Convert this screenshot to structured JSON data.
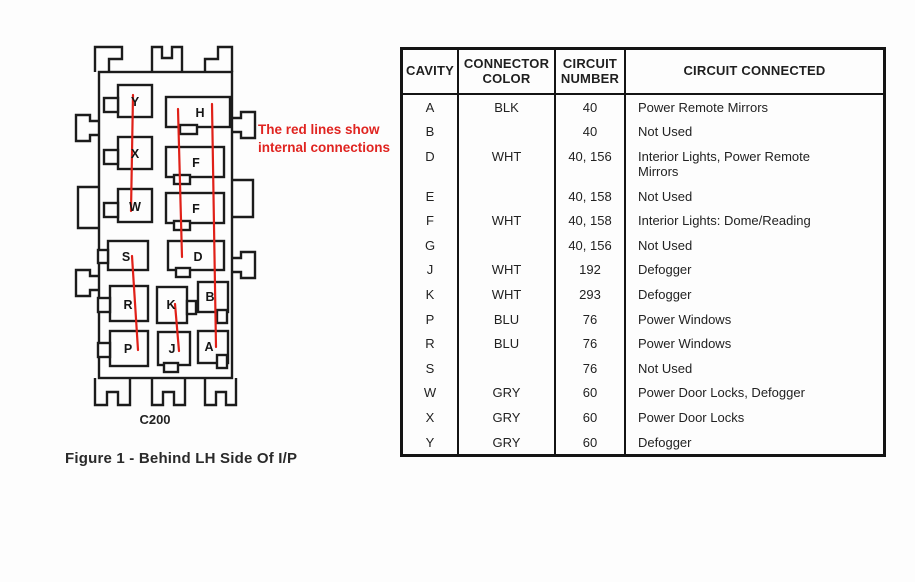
{
  "figure": {
    "connector_label": "C200",
    "caption": "Figure 1 - Behind LH Side Of I/P",
    "annotation": "The red lines show\ninternal connections",
    "cavities": [
      "Y",
      "H",
      "X",
      "F",
      "W",
      "F",
      "S",
      "D",
      "R",
      "K",
      "B",
      "P",
      "J",
      "A"
    ],
    "red_connections": [
      "Y-X-W",
      "H-F-F-D",
      "H-B-A",
      "S-P",
      "K-J"
    ]
  },
  "table": {
    "headers": {
      "cavity": "CAVITY",
      "color": "CONNECTOR\nCOLOR",
      "number": "CIRCUIT\nNUMBER",
      "connected": "CIRCUIT CONNECTED"
    },
    "rows": [
      {
        "cavity": "A",
        "color": "BLK",
        "number": "40",
        "connected": "Power Remote Mirrors"
      },
      {
        "cavity": "B",
        "color": "",
        "number": "40",
        "connected": "Not Used"
      },
      {
        "cavity": "D",
        "color": "WHT",
        "number": "40, 156",
        "connected": "Interior Lights, Power Remote\n Mirrors"
      },
      {
        "cavity": "E",
        "color": "",
        "number": "40, 158",
        "connected": "Not Used"
      },
      {
        "cavity": "F",
        "color": "WHT",
        "number": "40, 158",
        "connected": "Interior Lights: Dome/Reading"
      },
      {
        "cavity": "G",
        "color": "",
        "number": "40, 156",
        "connected": "Not Used"
      },
      {
        "cavity": "J",
        "color": "WHT",
        "number": "192",
        "connected": "Defogger"
      },
      {
        "cavity": "K",
        "color": "WHT",
        "number": "293",
        "connected": "Defogger"
      },
      {
        "cavity": "P",
        "color": "BLU",
        "number": "76",
        "connected": "Power Windows"
      },
      {
        "cavity": "R",
        "color": "BLU",
        "number": "76",
        "connected": "Power Windows"
      },
      {
        "cavity": "S",
        "color": "",
        "number": "76",
        "connected": "Not Used"
      },
      {
        "cavity": "W",
        "color": "GRY",
        "number": "60",
        "connected": "Power Door Locks, Defogger"
      },
      {
        "cavity": "X",
        "color": "GRY",
        "number": "60",
        "connected": "Power Door Locks"
      },
      {
        "cavity": "Y",
        "color": "GRY",
        "number": "60",
        "connected": "Defogger"
      }
    ]
  },
  "colors": {
    "line": "#1b1b1b",
    "red": "#e02018",
    "background": "#fdfdfd",
    "annotation_red": "#e02420"
  }
}
